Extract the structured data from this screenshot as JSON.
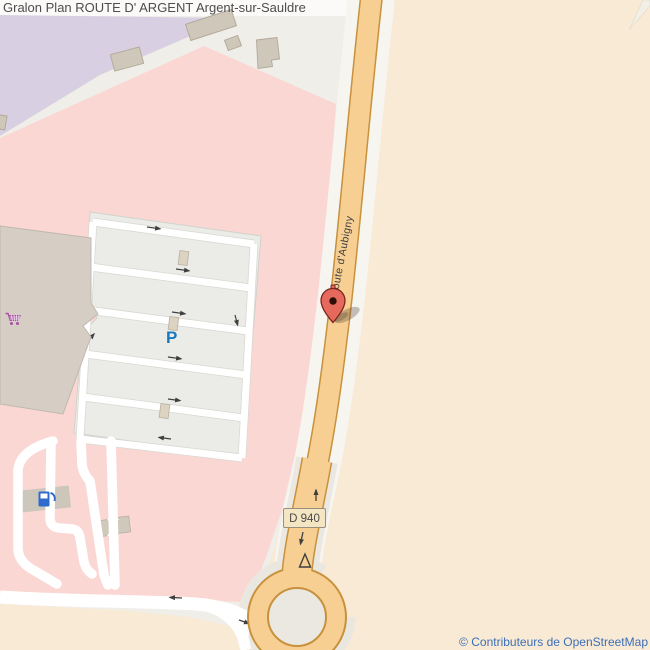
{
  "header": {
    "title": "Gralon Plan ROUTE D' ARGENT Argent-sur-Sauldre"
  },
  "map": {
    "street_label": "Route d'Aubigny",
    "road_ref_badge": "D 940",
    "parking_label": "P",
    "attribution": "© Contributeurs de OpenStreetMap",
    "icons": {
      "supermarket": "shopping-cart-icon",
      "fuel": "fuel-pump-icon",
      "marker": "map-pin-icon"
    },
    "colors": {
      "retail_area_pink": "#fbd7d3",
      "residential_area_purple": "#d8d0e2",
      "landuse_beige": "#f9ead6",
      "road_fill": "#f7cf93",
      "road_border": "#c8913c",
      "parking_gray": "#ebebe7",
      "building_gray": "#d6cec5",
      "marker_red": "#e56a5d",
      "attribution_blue": "#3b6fb5",
      "parking_p_blue": "#1a78be",
      "cart_magenta": "#a94fa4",
      "fuel_blue": "#2f6bcc"
    }
  }
}
